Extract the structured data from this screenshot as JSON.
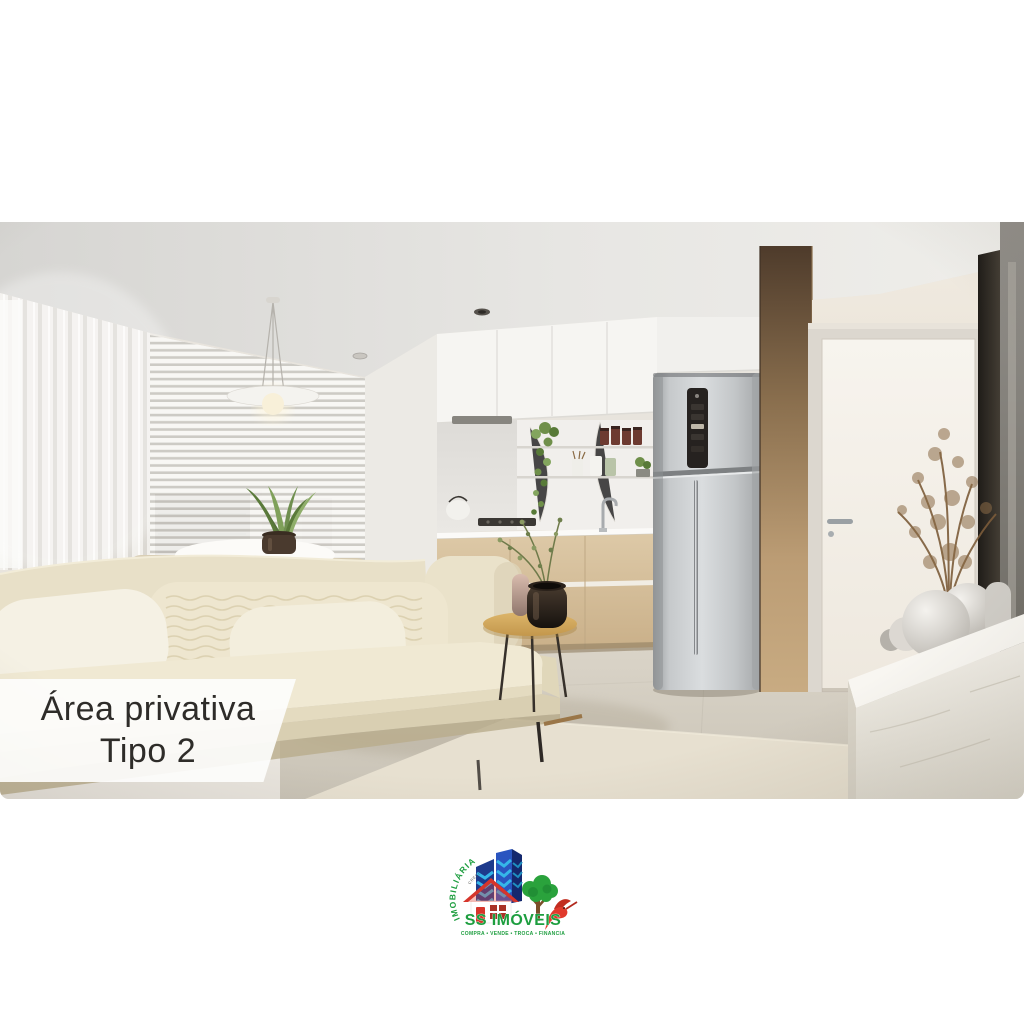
{
  "canvas": {
    "background": "#ffffff"
  },
  "badge": {
    "line1": "Área privativa",
    "line2": "Tipo 2",
    "text_color": "#2e2c29",
    "bg_color": "rgba(253,253,252,0.92)"
  },
  "scene": {
    "description": "3D interior render of a compact apartment: beige sofa with textured pillows, round white dining table with snake plant, sheer curtains and venetian blinds, pendant lamp, white kitchen cabinets with open marble shelf niche, wood base cabinets, stainless refrigerator, wood column, white door, marble console with round vases and dried plant, TV edge at right",
    "palette": {
      "wall": "#e8e4dd",
      "ceiling": "#e3e2df",
      "sofa": "#ebe3cb",
      "wood_cabinet": "#d5bf9c",
      "wood_column": "#b6976c",
      "fridge": "#c9ccce",
      "floor": "#d2ccc0",
      "rug": "#e7e0d0"
    }
  },
  "logo": {
    "arc_text": "IMOBILIÁRIA",
    "registry_text": "CRECI",
    "brand": "SS IMÓVEIS",
    "tagline": "COMPRA • VENDE • TROCA • FINANCIA",
    "colors": {
      "green": "#1d9e3f",
      "dark_blue": "#1d3a8c",
      "cyan": "#35b6e9",
      "red": "#d6352b",
      "trunk_brown": "#7a4f28"
    }
  }
}
